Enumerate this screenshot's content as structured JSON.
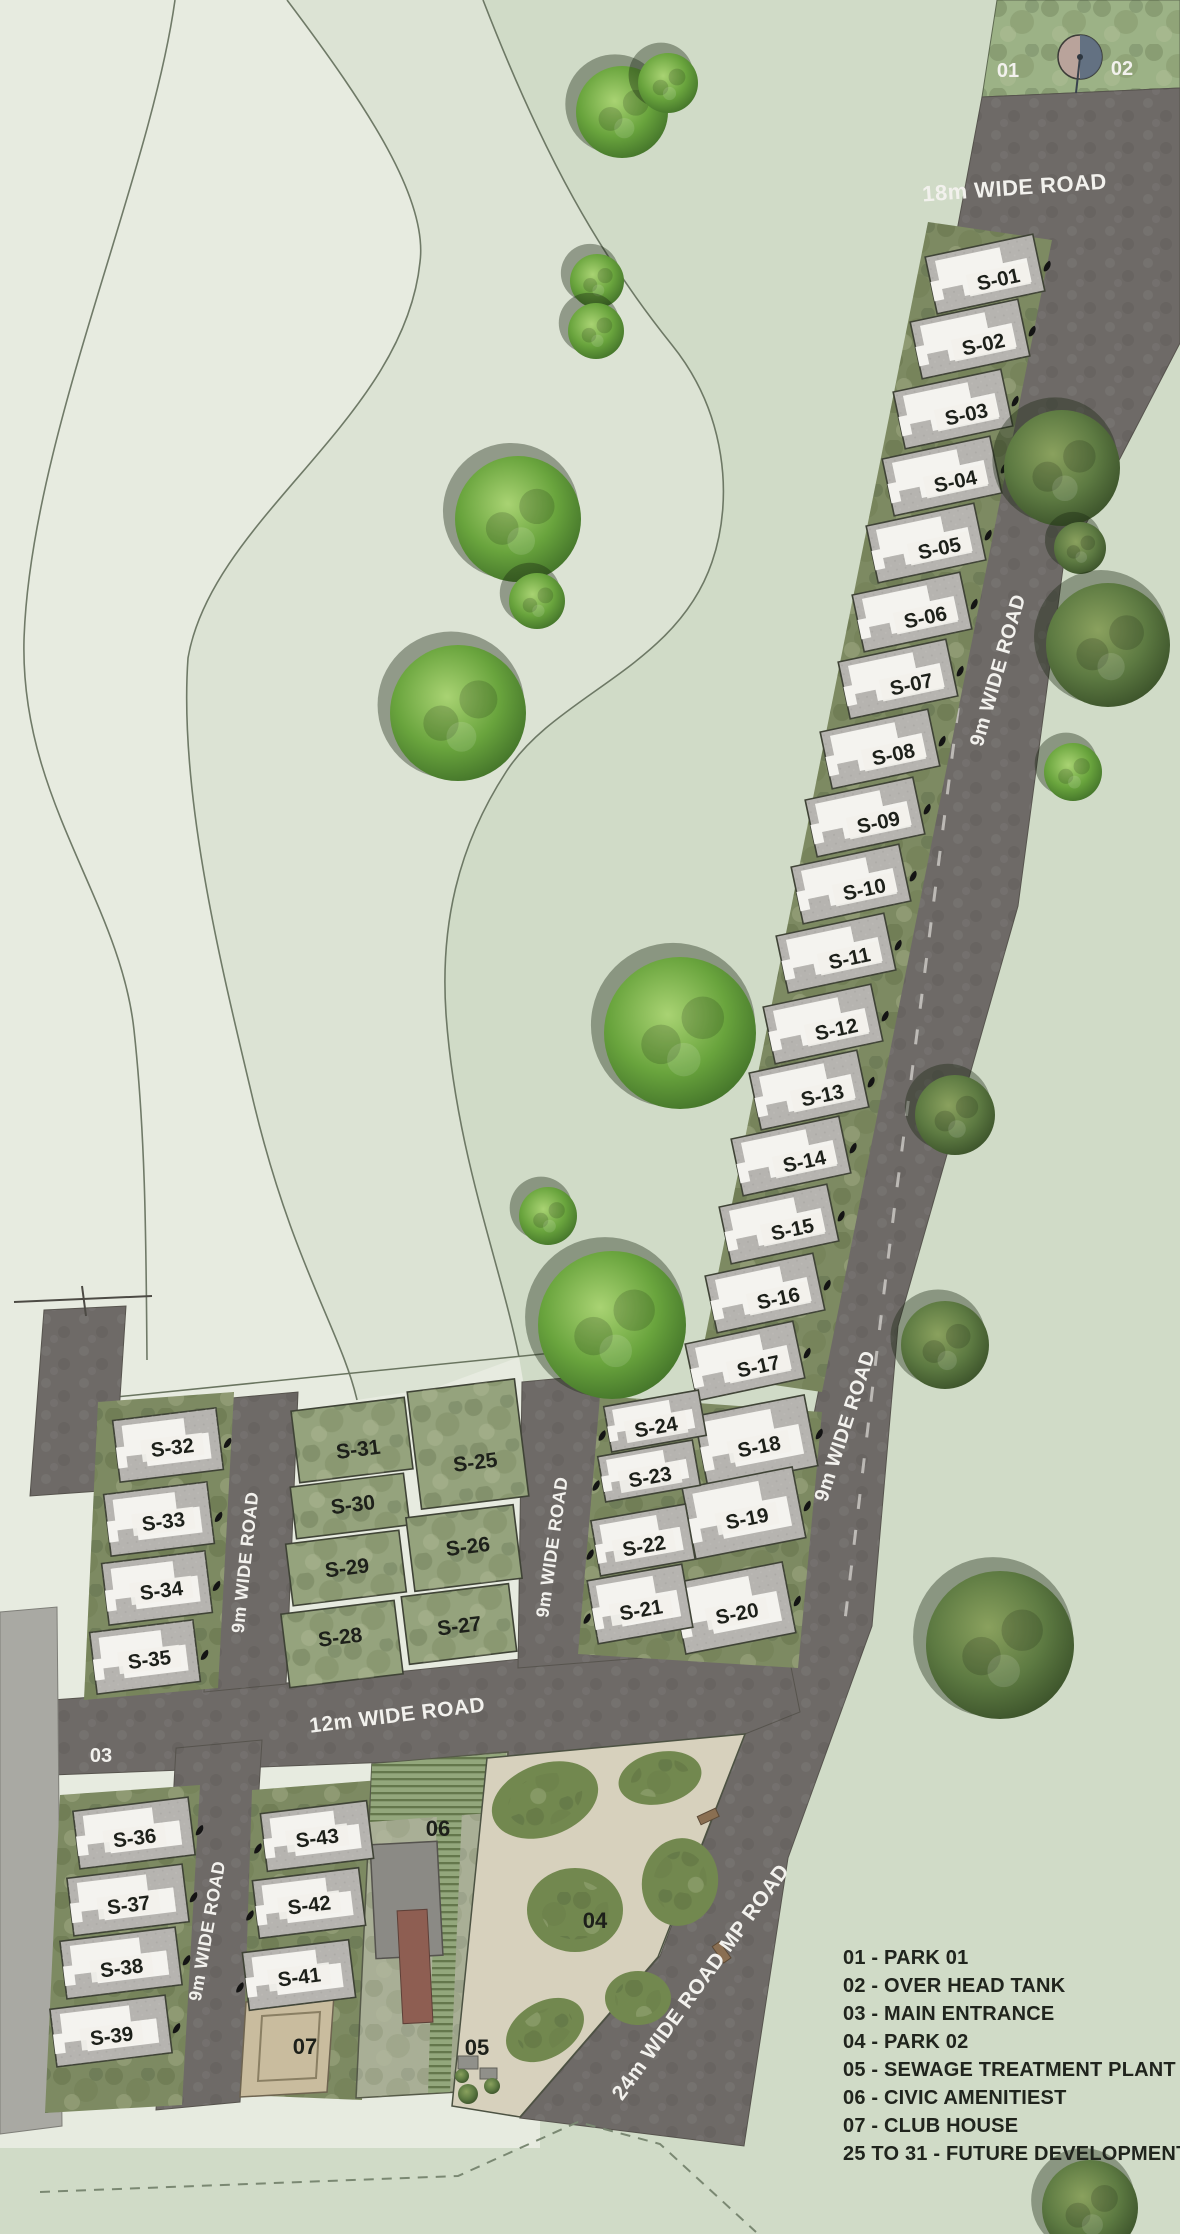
{
  "legend": {
    "items": [
      "01 - PARK 01",
      "02 - OVER HEAD TANK",
      "03 - MAIN ENTRANCE",
      "04 - PARK 02",
      "05 - SEWAGE TREATMENT PLANT",
      "06 - CIVIC AMENITIEST",
      "07 - CLUB HOUSE",
      "25 TO 31 - FUTURE DEVELOPMENT"
    ]
  },
  "road_labels": [
    {
      "text": "18m WIDE ROAD",
      "x": 1015,
      "y": 195,
      "rot": -4,
      "size": 22
    },
    {
      "text": "9m WIDE ROAD",
      "x": 1004,
      "y": 672,
      "rot": -74,
      "size": 20
    },
    {
      "text": "9m WIDE ROAD",
      "x": 851,
      "y": 1428,
      "rot": -72,
      "size": 20
    },
    {
      "text": "9m WIDE ROAD",
      "x": 558,
      "y": 1548,
      "rot": -82,
      "size": 18
    },
    {
      "text": "9m WIDE ROAD",
      "x": 251,
      "y": 1563,
      "rot": -84,
      "size": 18
    },
    {
      "text": "9m WIDE ROAD",
      "x": 213,
      "y": 1932,
      "rot": -80,
      "size": 18
    },
    {
      "text": "12m WIDE ROAD",
      "x": 398,
      "y": 1722,
      "rot": -7,
      "size": 21
    },
    {
      "text": "24m WIDE ROAD MP ROAD",
      "x": 706,
      "y": 1986,
      "rot": -54,
      "size": 21
    }
  ],
  "point_labels": [
    {
      "text": "01",
      "x": 1008,
      "y": 77,
      "color": "white"
    },
    {
      "text": "02",
      "x": 1122,
      "y": 75,
      "color": "white"
    },
    {
      "text": "03",
      "x": 101,
      "y": 1762,
      "color": "white"
    },
    {
      "text": "04",
      "x": 595,
      "y": 1928,
      "color": "black"
    },
    {
      "text": "05",
      "x": 477,
      "y": 2055,
      "color": "black"
    },
    {
      "text": "06",
      "x": 438,
      "y": 1836,
      "color": "black"
    },
    {
      "text": "07",
      "x": 305,
      "y": 2054,
      "color": "black"
    }
  ],
  "plots": {
    "main_column": [
      {
        "id": "S-01",
        "x": 997,
        "y": 282
      },
      {
        "id": "S-02",
        "x": 982,
        "y": 347
      },
      {
        "id": "S-03",
        "x": 965,
        "y": 417
      },
      {
        "id": "S-04",
        "x": 954,
        "y": 484
      },
      {
        "id": "S-05",
        "x": 938,
        "y": 551
      },
      {
        "id": "S-06",
        "x": 924,
        "y": 620
      },
      {
        "id": "S-07",
        "x": 910,
        "y": 687
      },
      {
        "id": "S-08",
        "x": 892,
        "y": 757
      },
      {
        "id": "S-09",
        "x": 877,
        "y": 825
      },
      {
        "id": "S-10",
        "x": 863,
        "y": 892
      },
      {
        "id": "S-11",
        "x": 848,
        "y": 961
      },
      {
        "id": "S-12",
        "x": 835,
        "y": 1032
      },
      {
        "id": "S-13",
        "x": 821,
        "y": 1098
      },
      {
        "id": "S-14",
        "x": 803,
        "y": 1164
      },
      {
        "id": "S-15",
        "x": 791,
        "y": 1232
      },
      {
        "id": "S-16",
        "x": 777,
        "y": 1301
      },
      {
        "id": "S-17",
        "x": 757,
        "y": 1369
      }
    ],
    "east_row": [
      {
        "id": "S-18",
        "x": 758,
        "y": 1447
      },
      {
        "id": "S-19",
        "x": 746,
        "y": 1519
      },
      {
        "id": "S-20",
        "x": 736,
        "y": 1614
      }
    ],
    "mid_row": [
      {
        "id": "S-24",
        "x": 655,
        "y": 1427
      },
      {
        "id": "S-23",
        "x": 649,
        "y": 1477
      },
      {
        "id": "S-22",
        "x": 643,
        "y": 1546
      },
      {
        "id": "S-21",
        "x": 640,
        "y": 1610
      }
    ],
    "west_column": [
      {
        "id": "S-32",
        "x": 172,
        "y": 1448
      },
      {
        "id": "S-33",
        "x": 163,
        "y": 1522
      },
      {
        "id": "S-34",
        "x": 161,
        "y": 1591
      },
      {
        "id": "S-35",
        "x": 149,
        "y": 1660
      }
    ],
    "southwest_column": [
      {
        "id": "S-36",
        "x": 134,
        "y": 1838
      },
      {
        "id": "S-37",
        "x": 128,
        "y": 1905
      },
      {
        "id": "S-38",
        "x": 121,
        "y": 1968
      },
      {
        "id": "S-39",
        "x": 111,
        "y": 2036
      }
    ],
    "south_mid_column": [
      {
        "id": "S-43",
        "x": 317,
        "y": 1838
      },
      {
        "id": "S-42",
        "x": 309,
        "y": 1905
      },
      {
        "id": "S-41",
        "x": 299,
        "y": 1977
      }
    ],
    "future_development": [
      {
        "id": "S-31",
        "x": 357,
        "y": 1450
      },
      {
        "id": "S-30",
        "x": 353,
        "y": 1505
      },
      {
        "id": "S-29",
        "x": 347,
        "y": 1568
      },
      {
        "id": "S-28",
        "x": 341,
        "y": 1637
      },
      {
        "id": "S-25",
        "x": 473,
        "y": 1463
      },
      {
        "id": "S-26",
        "x": 468,
        "y": 1547
      },
      {
        "id": "S-27",
        "x": 459,
        "y": 1626
      }
    ]
  },
  "vegetation": {
    "trees": [
      {
        "x": 622,
        "y": 112,
        "r": 46,
        "v": "bright"
      },
      {
        "x": 668,
        "y": 83,
        "r": 30,
        "v": "bright"
      },
      {
        "x": 597,
        "y": 281,
        "r": 27,
        "v": "bright"
      },
      {
        "x": 596,
        "y": 331,
        "r": 28,
        "v": "bright"
      },
      {
        "x": 518,
        "y": 519,
        "r": 63,
        "v": "bright"
      },
      {
        "x": 537,
        "y": 601,
        "r": 28,
        "v": "bright"
      },
      {
        "x": 1062,
        "y": 468,
        "r": 58,
        "v": "dark"
      },
      {
        "x": 1080,
        "y": 548,
        "r": 26,
        "v": "dark"
      },
      {
        "x": 458,
        "y": 713,
        "r": 68,
        "v": "bright"
      },
      {
        "x": 1108,
        "y": 645,
        "r": 62,
        "v": "dark"
      },
      {
        "x": 1073,
        "y": 772,
        "r": 29,
        "v": "bright"
      },
      {
        "x": 680,
        "y": 1033,
        "r": 76,
        "v": "bright"
      },
      {
        "x": 955,
        "y": 1115,
        "r": 40,
        "v": "dark"
      },
      {
        "x": 548,
        "y": 1216,
        "r": 29,
        "v": "bright"
      },
      {
        "x": 612,
        "y": 1325,
        "r": 74,
        "v": "bright"
      },
      {
        "x": 945,
        "y": 1345,
        "r": 44,
        "v": "dark"
      },
      {
        "x": 1000,
        "y": 1645,
        "r": 74,
        "v": "dark"
      },
      {
        "x": 1090,
        "y": 2208,
        "r": 48,
        "v": "dark"
      }
    ]
  },
  "colors": {
    "bg_east": "#d0dbc7",
    "bg_west": "#e7ebe0",
    "bg_band": "#dce3d4",
    "road": "#6e6a67",
    "plot": "#b6b4b0",
    "plot_border": "#3f4336",
    "green_base": "#7d8a62",
    "future": "#95a37d",
    "park_strip": "#9cb286",
    "park04_path": "#d7d1bd",
    "club_house": "#c9bc9e",
    "building": "#f4f3ef",
    "label_black": "#1d201a",
    "label_white": "#f2f1ed"
  }
}
